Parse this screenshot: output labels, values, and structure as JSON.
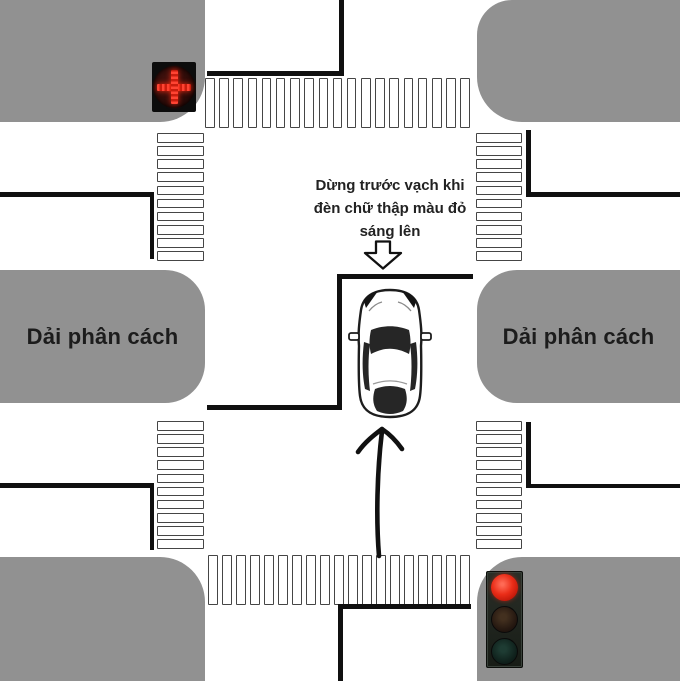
{
  "instruction": {
    "lines": [
      "Dừng trước vạch khi",
      "đèn chữ thập màu đỏ",
      "sáng lên"
    ]
  },
  "labels": {
    "median_left": "Dải phân cách",
    "median_right": "Dải phân cách"
  },
  "signals": {
    "lane_control_signal": "red-cross-lit",
    "traffic_light": "red-lit"
  },
  "colors": {
    "block_gray": "#919191",
    "road_white": "#ffffff",
    "marking_black": "#101010",
    "signal_red": "#e82d18"
  }
}
